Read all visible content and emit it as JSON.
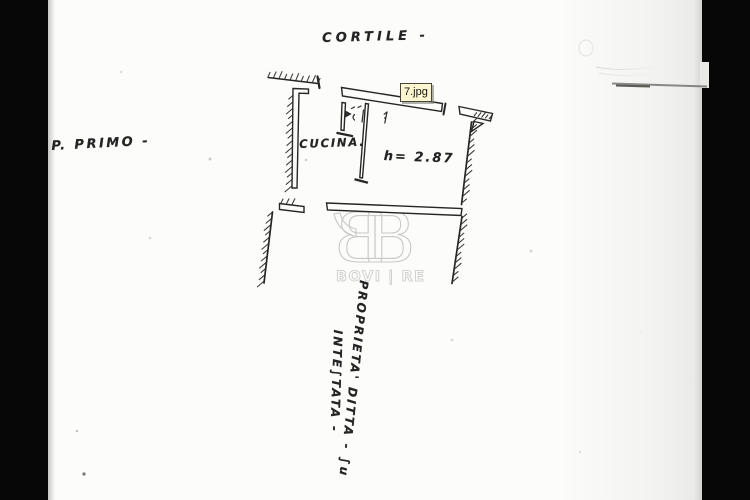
{
  "colors": {
    "paper": "#fcfcfb",
    "scan_bar": "#070707",
    "ink": "#262626",
    "watermark": "#c8c8c6",
    "tooltip_bg": "#fbf6cf",
    "tooltip_border": "#45453a"
  },
  "tooltip": {
    "filename": "7.jpg"
  },
  "plan_labels": {
    "courtyard": "CORTILE -",
    "floor_level": "P. PRIMO -",
    "room": "CUCINA.",
    "ceiling_height": "h= 2.87",
    "property_note_line1": "PROPRIETA' DITTA - ∫u",
    "property_note_line2": "INTE∫TATA -"
  },
  "watermark": {
    "monogram_letter": "B",
    "name": "BOVI | RE"
  }
}
